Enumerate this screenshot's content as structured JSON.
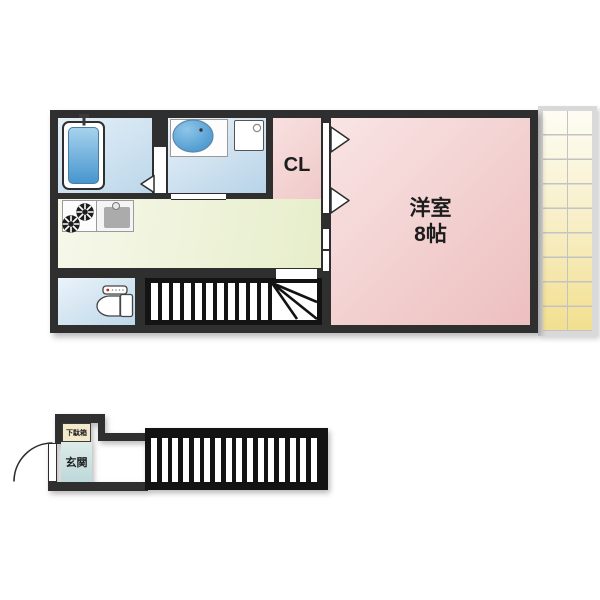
{
  "floor_plan": {
    "upper_floor": {
      "closet_label": "CL",
      "main_room": {
        "name": "洋室",
        "size": "8帖"
      }
    },
    "lower_floor": {
      "shoe_cabinet_label": "下駄箱",
      "entrance_label": "玄関"
    },
    "fixtures": {
      "bathtub": "bathtub",
      "washbasin": "oval-washbasin",
      "washing_machine_pan": "washing-machine-pan",
      "stove": "two-burner-stove",
      "kitchen_sink": "kitchen-sink",
      "toilet": "toilet",
      "upper_stairs": "staircase-with-winder",
      "lower_stairs": "straight-staircase",
      "entrance_door": "outward-swing-door",
      "balcony": "tiled-balcony"
    },
    "colors": {
      "wall": "#2f2f2f",
      "stairs_fill": "#131313",
      "wet_area_blue": "#cfe2f0",
      "fixture_blue": "#4796cf",
      "room_pink": "#f3cfcf",
      "kitchen_green": "#edf2d4",
      "balcony_yellow": "#f2df8e",
      "entrance_teal": "#cfe1e3",
      "cabinet_cream": "#f3e9cb"
    }
  }
}
